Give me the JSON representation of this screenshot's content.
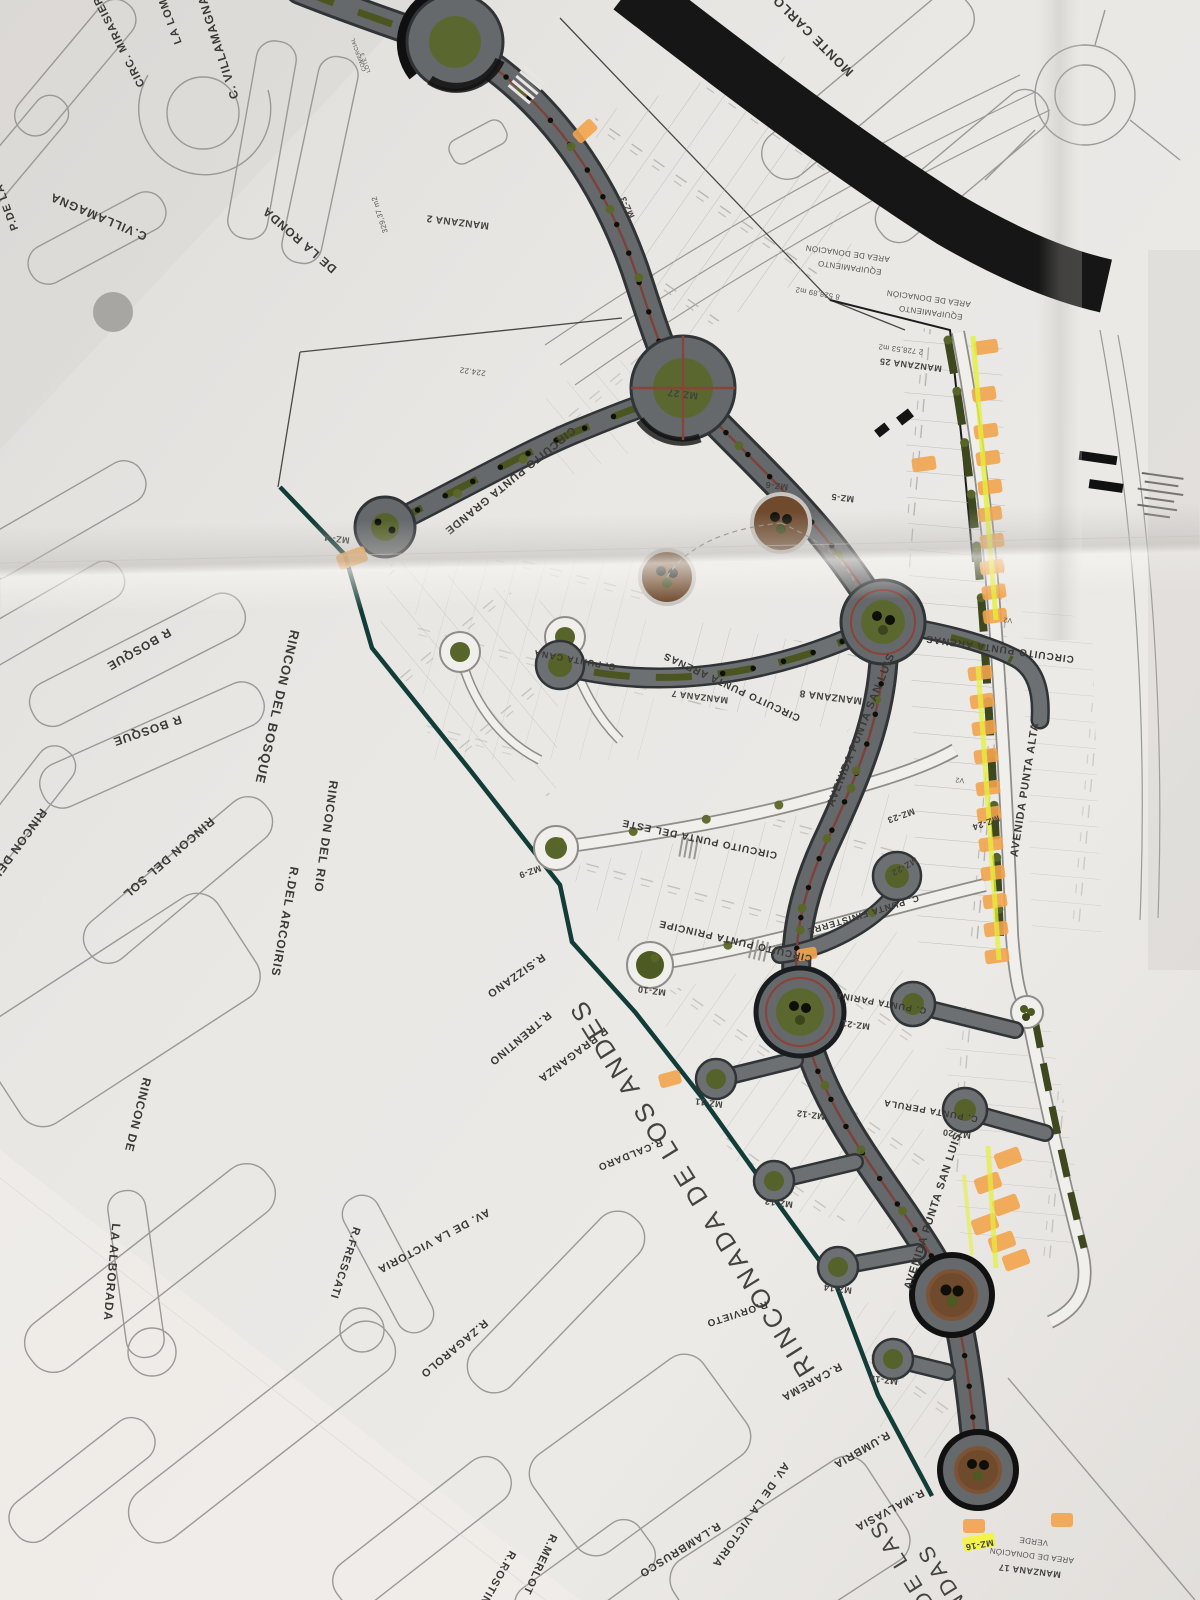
{
  "map": {
    "street_labels": [
      {
        "text": "LA LOMA"
      },
      {
        "text": "CIRC. MIRASIER"
      },
      {
        "text": "C. VILLAMAGNA"
      },
      {
        "text": "P.DE LA"
      },
      {
        "text": "C.VILLAMAGNA"
      },
      {
        "text": "DE LA RONDA"
      },
      {
        "text": "MONTE CARLO"
      },
      {
        "text": "R BOSQUE"
      },
      {
        "text": "R BOSQUE"
      },
      {
        "text": "RINCON DEL BOSQUE"
      },
      {
        "text": "RINCON DEL"
      },
      {
        "text": "RINCON DEL SOL"
      },
      {
        "text": "RINCON DEL RIO"
      },
      {
        "text": "R.DEL ARCOIRIS"
      },
      {
        "text": "RINCON DE"
      },
      {
        "text": "R.SIZZANO"
      },
      {
        "text": "R.TRENTINO"
      },
      {
        "text": "R.BRAGANZA"
      },
      {
        "text": "R.CALDARO"
      },
      {
        "text": "RINCONADA DE LOS ANDES"
      },
      {
        "text": "R.ORVIETO"
      },
      {
        "text": "R.CAREMA"
      },
      {
        "text": "R.UMBRIA"
      },
      {
        "text": "R.MALVASIA"
      },
      {
        "text": "LA ALBORADA"
      },
      {
        "text": "AV. DE LA VICTORIA"
      },
      {
        "text": "R.FRESCATI"
      },
      {
        "text": "R.ZAGAROLO"
      },
      {
        "text": "AV. DE LA VICTORIA"
      },
      {
        "text": "R.MERLOT"
      },
      {
        "text": "R.LAMBRUSCO"
      },
      {
        "text": "R.ROSTINI"
      },
      {
        "text": "CIRCUITO PUNTA GRANDE"
      },
      {
        "text": "CIRCUITO PUNTA ARENAS"
      },
      {
        "text": "CIRCUITO PUNTA ARENAS"
      },
      {
        "text": "AVENIDA PUNTA SAN LUIS"
      },
      {
        "text": "AVENIDA PUNTA SAN LUIS"
      },
      {
        "text": "AVENIDA PUNTA ALTA"
      },
      {
        "text": "CIRCUITO PUNTA DEL ESTE"
      },
      {
        "text": "CIRCUITO PUNTA PRINCIPE"
      },
      {
        "text": "C. PUNTA FINISTERRE"
      },
      {
        "text": "C. PUNTA PARINA"
      },
      {
        "text": "C. PUNTA PERULA"
      },
      {
        "text": "C. PUNTA CANA"
      },
      {
        "text": "DE LAS"
      },
      {
        "text": "IENDAS"
      }
    ],
    "block_labels": [
      {
        "text": "MANZANA 2"
      },
      {
        "text": "MZ-3"
      },
      {
        "text": "MZ- 4"
      },
      {
        "text": "MZ-5"
      },
      {
        "text": "MZ-6"
      },
      {
        "text": "MZ 27"
      },
      {
        "text": "MANZANA 25"
      },
      {
        "text": "2 728,53 m2"
      },
      {
        "text": "MANZANA 7"
      },
      {
        "text": "MANZANA 8"
      },
      {
        "text": "MZ-9"
      },
      {
        "text": "MZ-10"
      },
      {
        "text": "MZ-11"
      },
      {
        "text": "MZ-12"
      },
      {
        "text": "MZ-13"
      },
      {
        "text": "MZ-14"
      },
      {
        "text": "MZ-15"
      },
      {
        "text": "MZ-16"
      },
      {
        "text": "MZ-20"
      },
      {
        "text": "MZ-21"
      },
      {
        "text": "MZ-22"
      },
      {
        "text": "MZ-23"
      },
      {
        "text": "MZ-24"
      },
      {
        "text": "MANZANA 17"
      },
      {
        "text": "AREA DE DONACIÓN"
      },
      {
        "text": "VERDE"
      }
    ],
    "area_labels": [
      {
        "text": "AREA DE DONACIÓN"
      },
      {
        "text": "EQUIPAMIENTO"
      },
      {
        "text": "8 528,89 m2"
      },
      {
        "text": "AREA DE DONACIÓN"
      },
      {
        "text": "EQUIPAMIENTO"
      },
      {
        "text": "329,37 m2"
      },
      {
        "text": "224.22"
      },
      {
        "text": "COMERCIAL"
      },
      {
        "text": "LOTE 3"
      },
      {
        "text": "V2"
      },
      {
        "text": "V2"
      }
    ],
    "colors": {
      "paper": "#e7e5e2",
      "road_dark": "#66696c",
      "road_casing": "#303436",
      "olive_green": "#57652b",
      "dark_olive": "#3d481e",
      "median_red": "#7d4038",
      "boundary_teal": "#123c38",
      "highlight_orange": "#f2a44c",
      "highlighter_yellow": "#e4f03a",
      "park_brown": "#6f4a2d",
      "existing_street_gray": "#9b9998",
      "black_road": "#161616",
      "ink": "#3b3935"
    }
  }
}
